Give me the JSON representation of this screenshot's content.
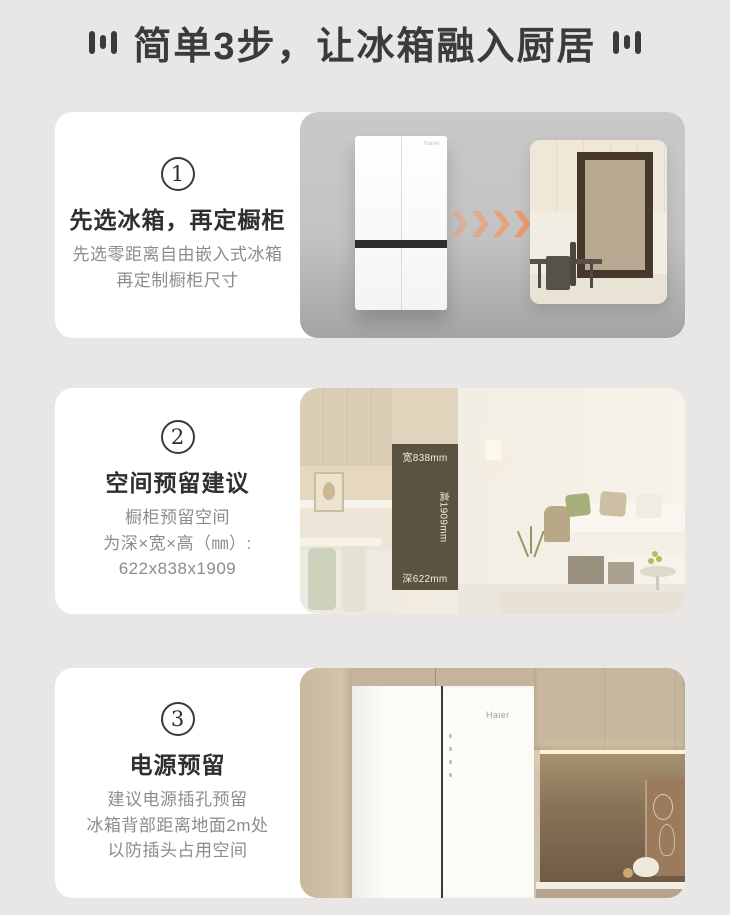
{
  "header": {
    "title": "简单3步，让冰箱融入厨居"
  },
  "steps": [
    {
      "number": "1",
      "title": "先选冰箱，再定橱柜",
      "lines": [
        "先选零距离自由嵌入式冰箱",
        "再定制橱柜尺寸"
      ]
    },
    {
      "number": "2",
      "title": "空间预留建议",
      "lines": [
        "橱柜预留空间",
        "为深×宽×高（㎜）:",
        "622x838x1909"
      ]
    },
    {
      "number": "3",
      "title": "电源预留",
      "lines": [
        "建议电源插孔预留",
        "冰箱背部距离地面2m处",
        "以防插头占用空间"
      ]
    }
  ],
  "scene1": {
    "brand": "Haier"
  },
  "scene2": {
    "width_label": "宽838mm",
    "height_label": "高1909mm",
    "depth_label": "深622mm"
  },
  "scene3": {
    "brand": "Haier"
  },
  "colors": {
    "accent_arrow": "#F09A66",
    "reserve_box": "#5A5342",
    "page_bg": "#E8E7E5"
  }
}
